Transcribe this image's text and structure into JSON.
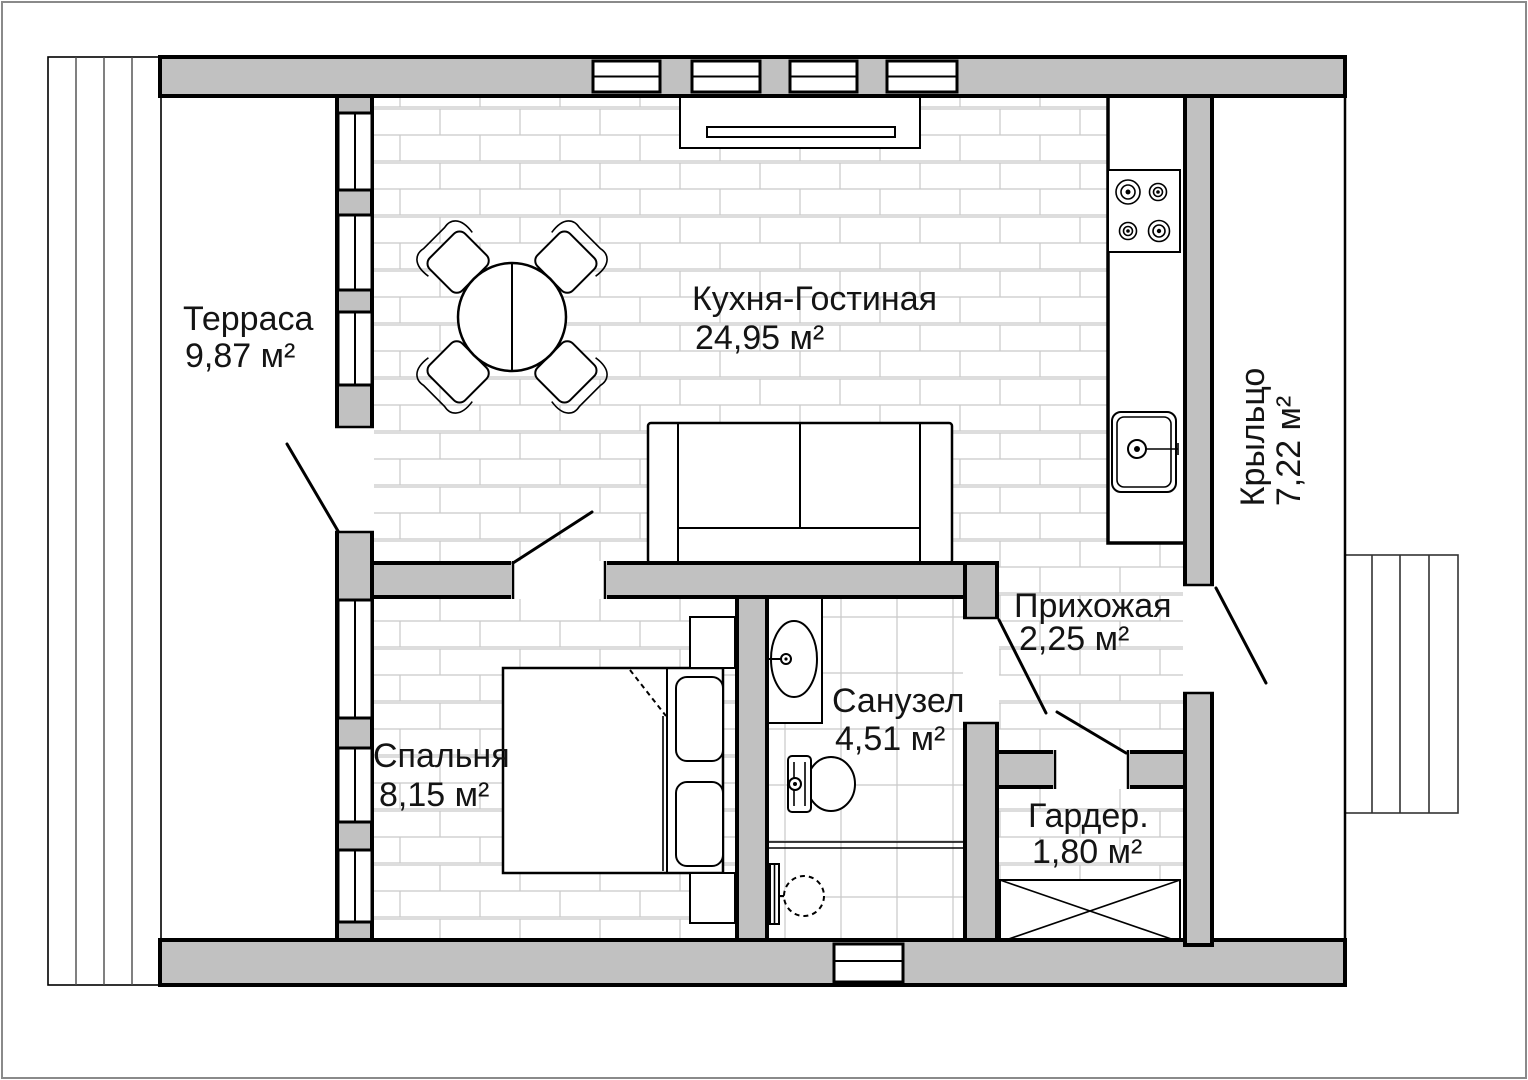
{
  "drawing": {
    "type": "apartment-floor-plan",
    "language": "ru"
  },
  "colors": {
    "wall_fill": "#c1c1c1",
    "outline": "#000000",
    "floor_joint": "#c9c9c9",
    "background": "#ffffff",
    "page_frame": "#8a8a8a"
  },
  "rooms": {
    "terrace": {
      "name": "Терраса",
      "area": "9,87 м²"
    },
    "kitchen_living": {
      "name": "Кухня-Гостиная",
      "area": "24,95 м²"
    },
    "porch": {
      "name": "Крыльцо",
      "area": "7,22 м²"
    },
    "bedroom": {
      "name": "Спальня",
      "area": "8,15 м²"
    },
    "bathroom": {
      "name": "Санузел",
      "area": "4,51 м²"
    },
    "hallway": {
      "name": "Прихожая",
      "area": "2,25 м²"
    },
    "wardrobe": {
      "name": "Гардер.",
      "area": "1,80 м²"
    }
  }
}
